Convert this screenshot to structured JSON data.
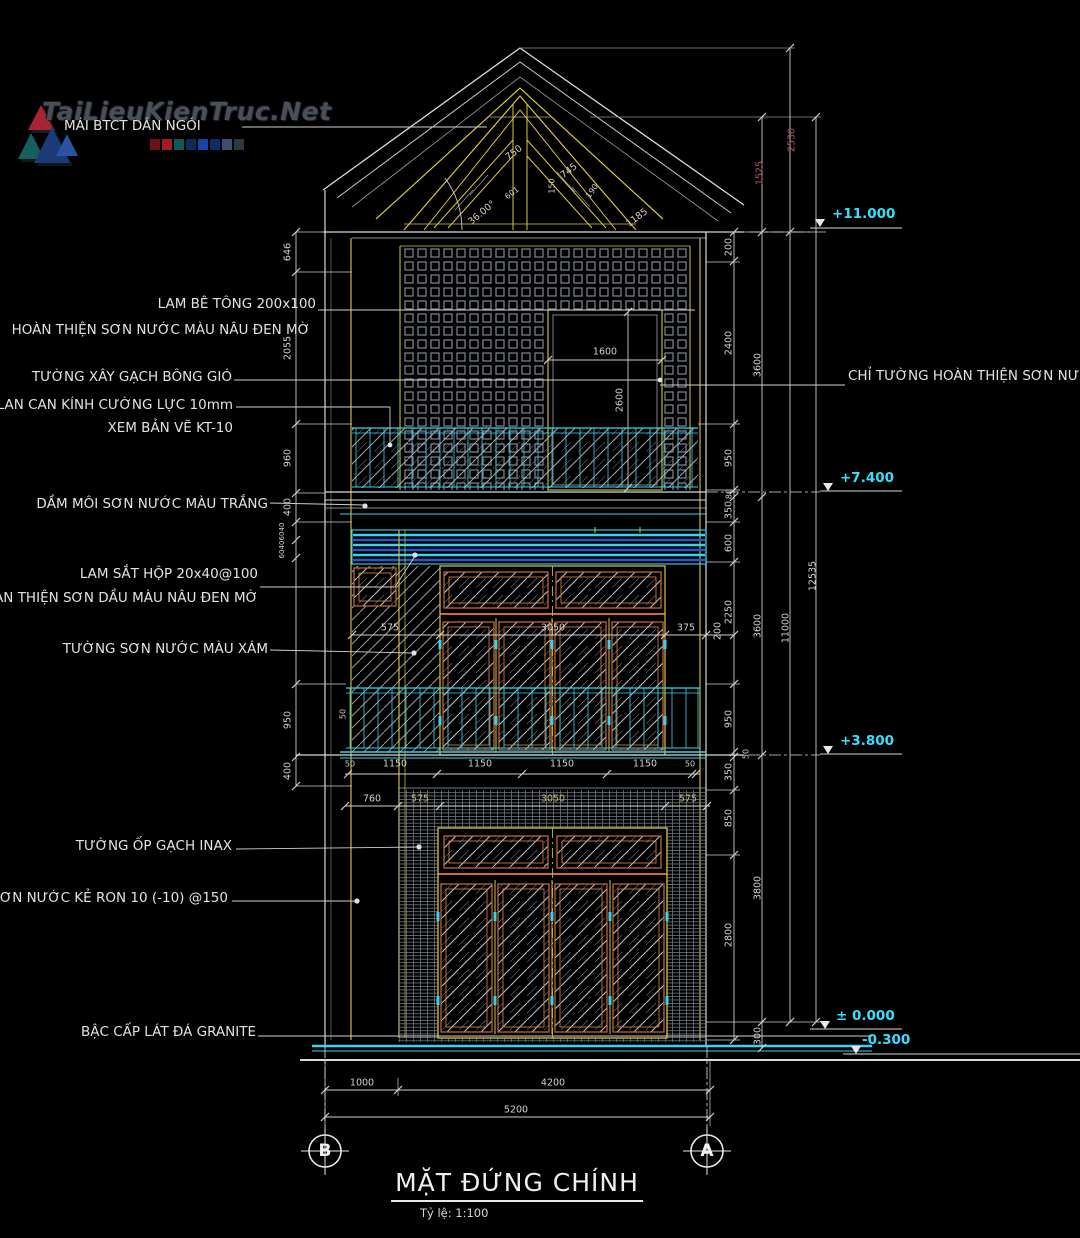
{
  "watermark": {
    "brand": "TaiLieuKienTruc.Net"
  },
  "callouts": {
    "roof": "MÁI BTCT DÁN NGÓI",
    "lam_be_tong_l1": "LAM BÊ TÔNG 200x100",
    "lam_be_tong_l2": "HOÀN THIỆN SƠN NƯỚC MÀU NÂU ĐEN MỜ",
    "breeze_block_wall": "TƯỜNG XÂY GẠCH BÔNG GIÓ",
    "glass_railing_l1": "LAN CAN KÍNH CƯỜNG LỰC 10mm",
    "glass_railing_l2": "XEM BẢN VẼ KT-10",
    "drip_beam": "DẦM MÔI SƠN NƯỚC MÀU TRẮNG",
    "steel_louvre_l1": "LAM SẮT HỘP 20x40@100",
    "steel_louvre_l2": "ÀN THIỆN SƠN DẦU MÀU NÂU ĐEN MỜ",
    "grey_paint_wall": "TƯỜNG SƠN NƯỚC MÀU XÁM",
    "inax_tile_wall": "TƯỜNG ỐP GẠCH INAX",
    "groove_paint": "SƠN NƯỚC KẺ RON 10 (-10) @150",
    "granite_step": "BẬC CẤP LÁT ĐÁ GRANITE",
    "right_wall_finish": "CHỈ TƯỜNG HOÀN THIỆN SƠN NƯ"
  },
  "levels": {
    "top": "+11.000",
    "third": "+7.400",
    "second": "+3.800",
    "ground": "± 0.000",
    "base": "-0.300"
  },
  "dims": {
    "left": [
      "646",
      "2055",
      "960",
      "400",
      "950",
      "400"
    ],
    "left_small": [
      "40",
      "60",
      "40",
      "60"
    ],
    "rail_offset": "50",
    "right_a": [
      "200",
      "2400",
      "950",
      "80",
      "350",
      "600",
      "2250",
      "950",
      "50",
      "350",
      "850",
      "2800"
    ],
    "right_b": [
      "1525",
      "3600",
      "3600",
      "3800",
      "300"
    ],
    "right_c": [
      "2530",
      "11000"
    ],
    "right_total": "12535",
    "door3": [
      "1600",
      "2600"
    ],
    "floor2_chain": [
      "575",
      "3050",
      "375",
      "200"
    ],
    "slab_chain": [
      "50",
      "1150",
      "1150",
      "1150",
      "1150",
      "50"
    ],
    "ground_chain": [
      "760",
      "575",
      "3050",
      "575"
    ],
    "bottom": [
      "1000",
      "4200",
      "5200"
    ],
    "roof": [
      "750",
      "745",
      "601",
      "150",
      "190",
      "1185"
    ],
    "roof_angle": "36.00°"
  },
  "axes": {
    "left": "B",
    "right": "A"
  },
  "title": {
    "text": "MẶT ĐỨNG CHÍNH",
    "scale": "Tỷ lệ: 1:100"
  },
  "palette": {
    "line_white": "#d9d9d9",
    "line_yellow": "#d8c83c",
    "line_cyan": "#3ad2f0",
    "line_blue": "#2b55c8",
    "line_orange": "#cf6a38",
    "dim_text": "#d9cfc8",
    "level_text": "#35e0ff"
  }
}
